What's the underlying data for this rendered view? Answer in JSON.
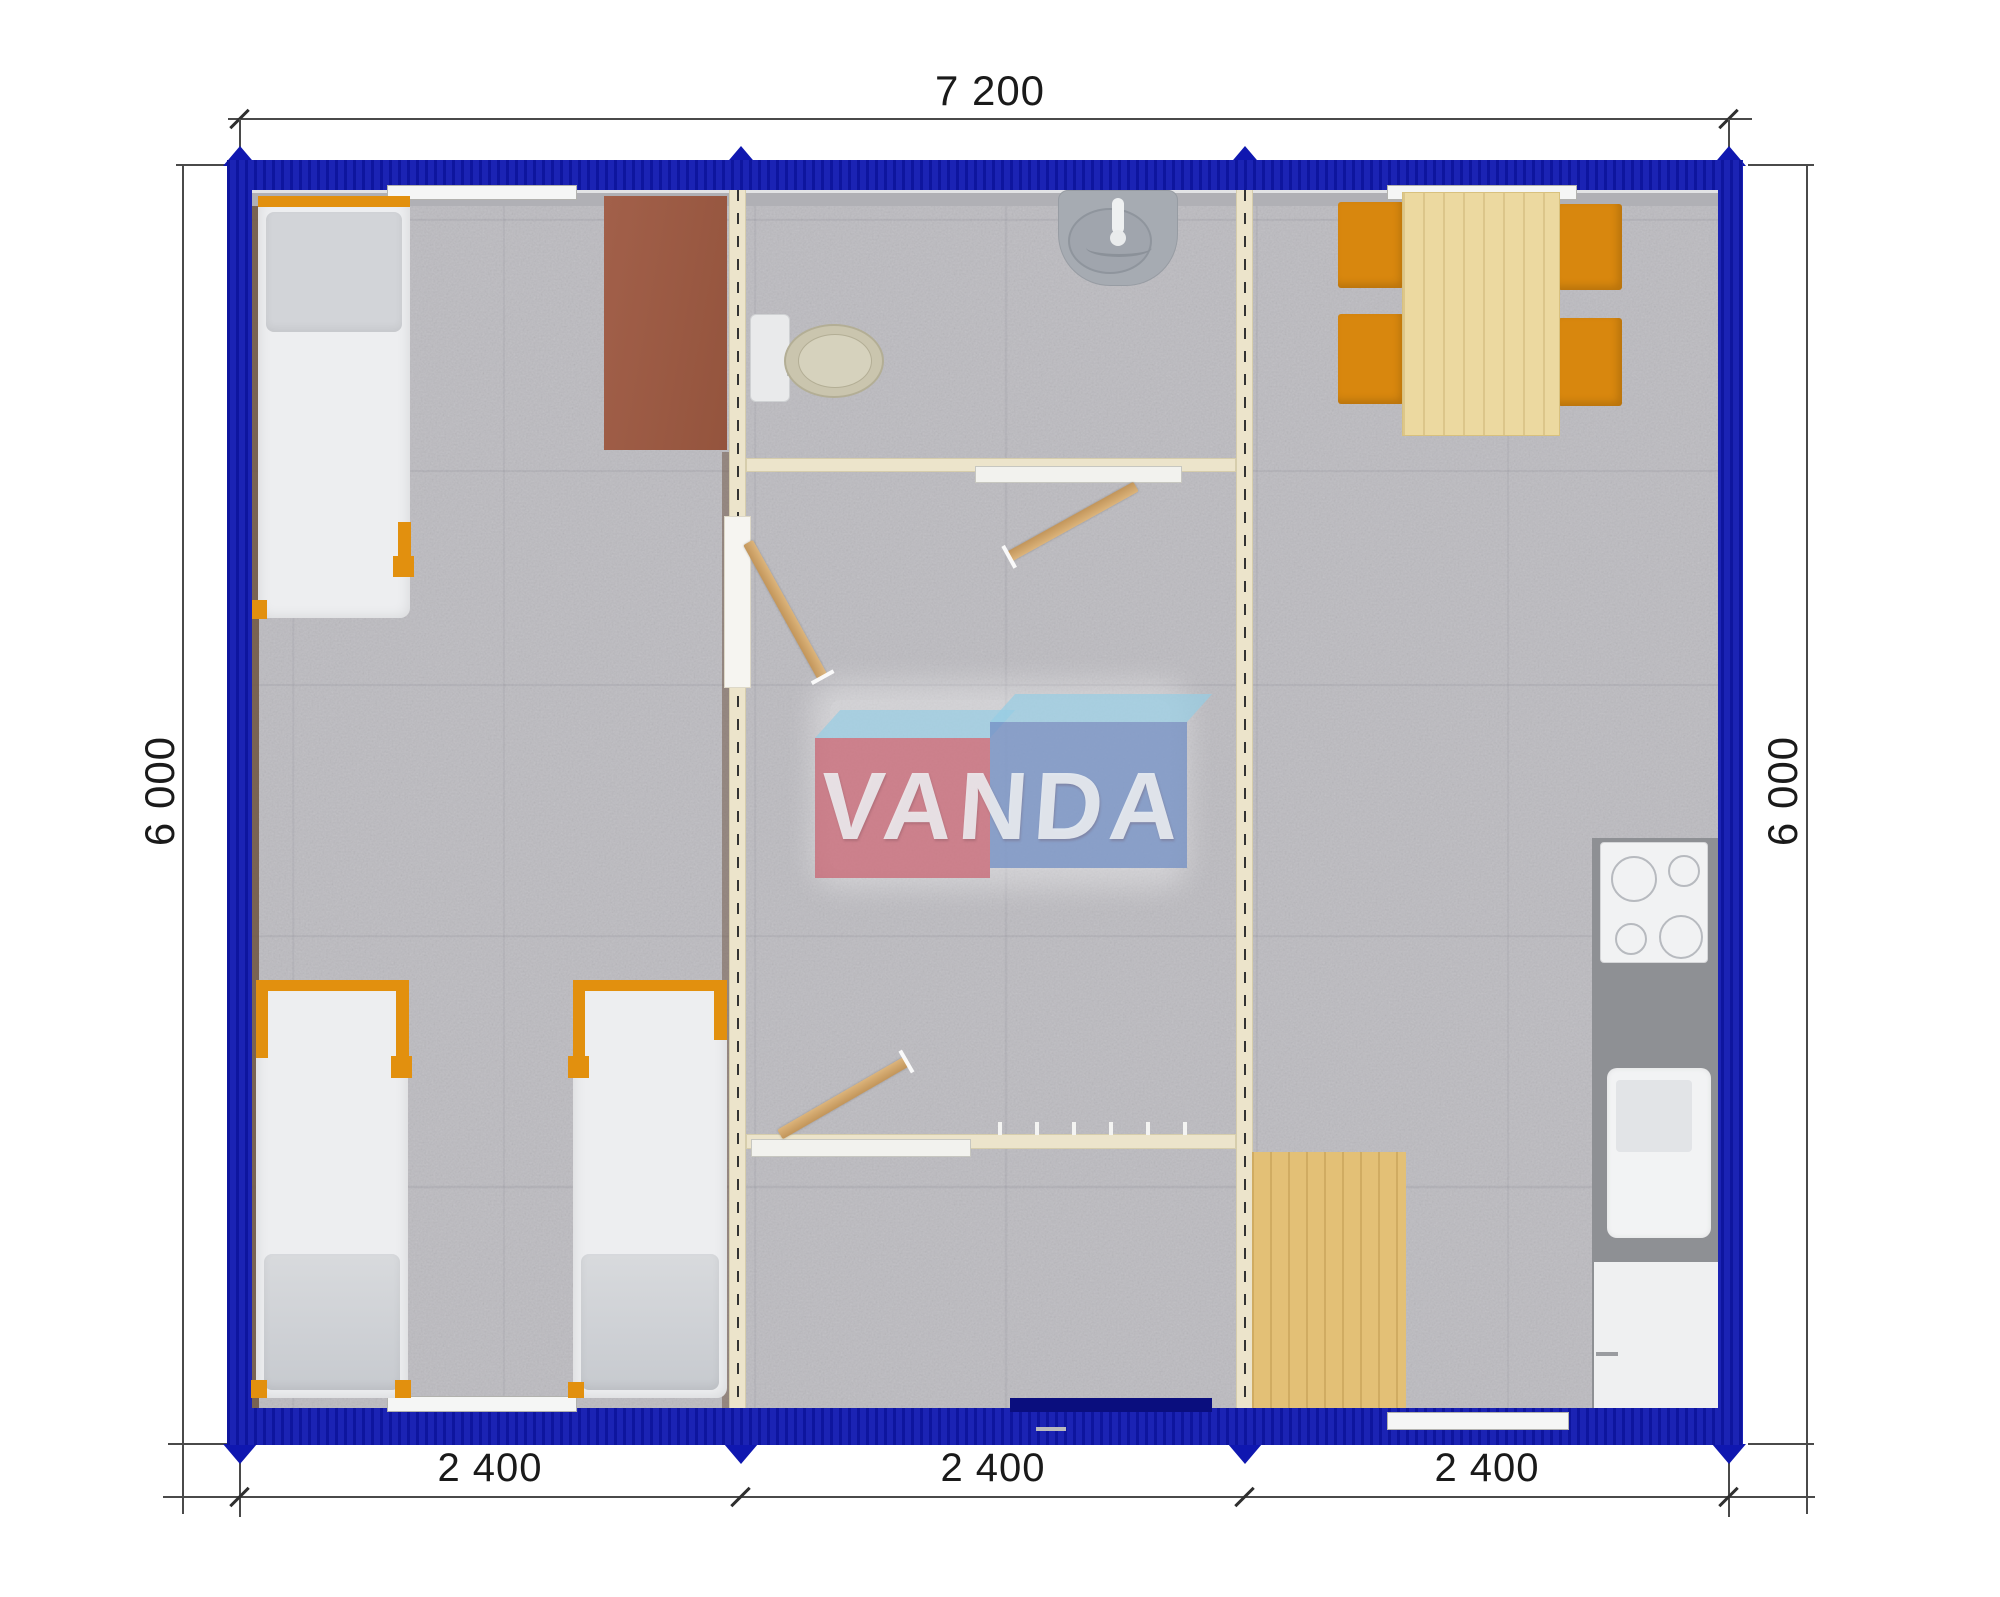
{
  "document": {
    "type": "architectural floor plan (top view render)",
    "brand": "VANDA"
  },
  "dimension_labels": {
    "top": "7 200",
    "left": "6 000",
    "right": "6 000",
    "bottom": [
      "2 400",
      "2 400",
      "2 400"
    ]
  },
  "watermark": {
    "text": "VANDA"
  },
  "furniture": {
    "left_module": [
      "single-bed",
      "single-bed",
      "single-bed",
      "desk-table"
    ],
    "middle_module": [
      "toilet",
      "washbasin",
      "swing-door",
      "swing-door",
      "swing-door",
      "entrance-door"
    ],
    "right_module": [
      "dining-table",
      "chair",
      "chair",
      "chair",
      "chair",
      "cooktop",
      "kitchen-sink",
      "base-cabinet",
      "wood-floor-mat"
    ]
  },
  "colors": {
    "wall_blue": "#0f17b0",
    "wall_blue_dark": "#0a0e7e",
    "orange": "#e2900e",
    "partition_cream": "#ece4cb",
    "door_wood": "#cfa063",
    "floor_gray": "#bcbbc0",
    "table_wood": "#ecd9a0",
    "mat_wood": "#e3c076",
    "counter_gray": "#8e9094",
    "desk_brown": "#9b5a41",
    "watermark_pink": "#c95e6c",
    "watermark_blue": "#728fc4",
    "watermark_top": "#96cde4",
    "dim_line": "#4a4a4a"
  }
}
